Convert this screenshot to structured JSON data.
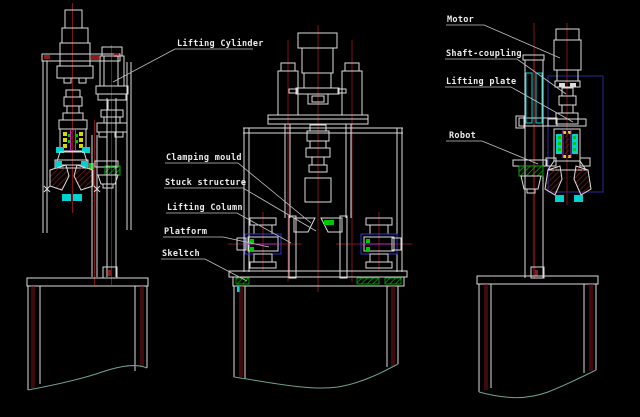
{
  "canvas": {
    "width": 640,
    "height": 417,
    "background": "#000000"
  },
  "palette": {
    "line": "#dcdcdc",
    "centerline_red": "#7e1416",
    "hatch_red": "#8c1a1a",
    "accent_cyan": "#00d2d2",
    "accent_green": "#00c800",
    "accent_yellow": "#d8d800",
    "accent_magenta": "#c028c0",
    "accent_blue": "#3434c8",
    "selection_navy": "#1e1e6e",
    "break_line_teal": "#6fa396",
    "label_text": "#ececec",
    "leader_line": "#c4c4c4"
  },
  "labels": {
    "lifting_cylinder": "Lifting Cylinder",
    "motor": "Motor",
    "shaft_coupling": "Shaft-coupling",
    "lifting_plate": "Lifting plate",
    "robot": "Robot",
    "clamping_mould": "Clamping mould",
    "stuck_structure": "Stuck structure",
    "lifting_column": "Lifting Column",
    "platform": "Platform",
    "skeltch": "Skeltch"
  }
}
